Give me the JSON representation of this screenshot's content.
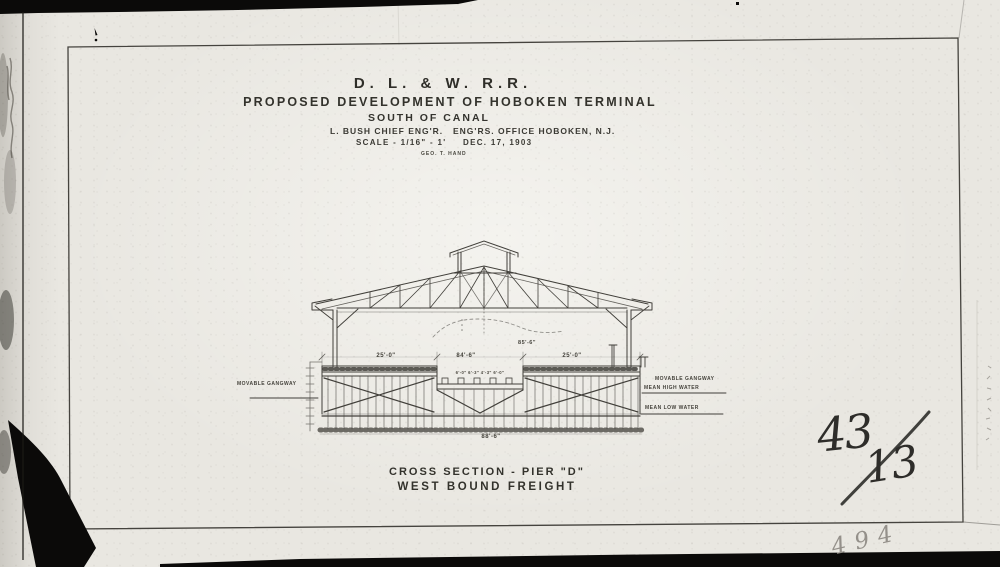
{
  "title_block": {
    "railroad": "D. L. & W. R.R.",
    "line2": "PROPOSED DEVELOPMENT OF HOBOKEN TERMINAL",
    "line3": "SOUTH OF CANAL",
    "engineer": "L. BUSH CHIEF ENG'R.",
    "office": "ENG'RS. OFFICE HOBOKEN, N.J.",
    "scale": "SCALE - 1/16\" - 1'",
    "date": "DEC. 17, 1903",
    "signature": "GEO. T. HAND"
  },
  "caption": {
    "line1": "CROSS SECTION - PIER \"D\"",
    "line2": "WEST BOUND FREIGHT"
  },
  "labels": {
    "left_gangway": "MOVABLE GANGWAY",
    "right_gangway": "MOVABLE GANGWAY",
    "mean_high_water": "MEAN HIGH WATER",
    "mean_low_water": "MEAN LOW WATER"
  },
  "dimensions": {
    "left_span": "25'-0\"",
    "center_span": "84'-6\"",
    "right_span": "25'-0\"",
    "upper_span": "85'-6\"",
    "track_spacings": "6'-0\"  6'-3\"  4'-3\"  6'-0\"",
    "overall_bottom": "88'-6\""
  },
  "annotations": {
    "drawing_number_numerator": "43",
    "drawing_number_denominator": "13",
    "page_number": "494"
  },
  "colors": {
    "paper": "#e9e7e1",
    "ink": "#413f3a",
    "pencil": "#94908a",
    "film_black": "#0b0a09"
  }
}
